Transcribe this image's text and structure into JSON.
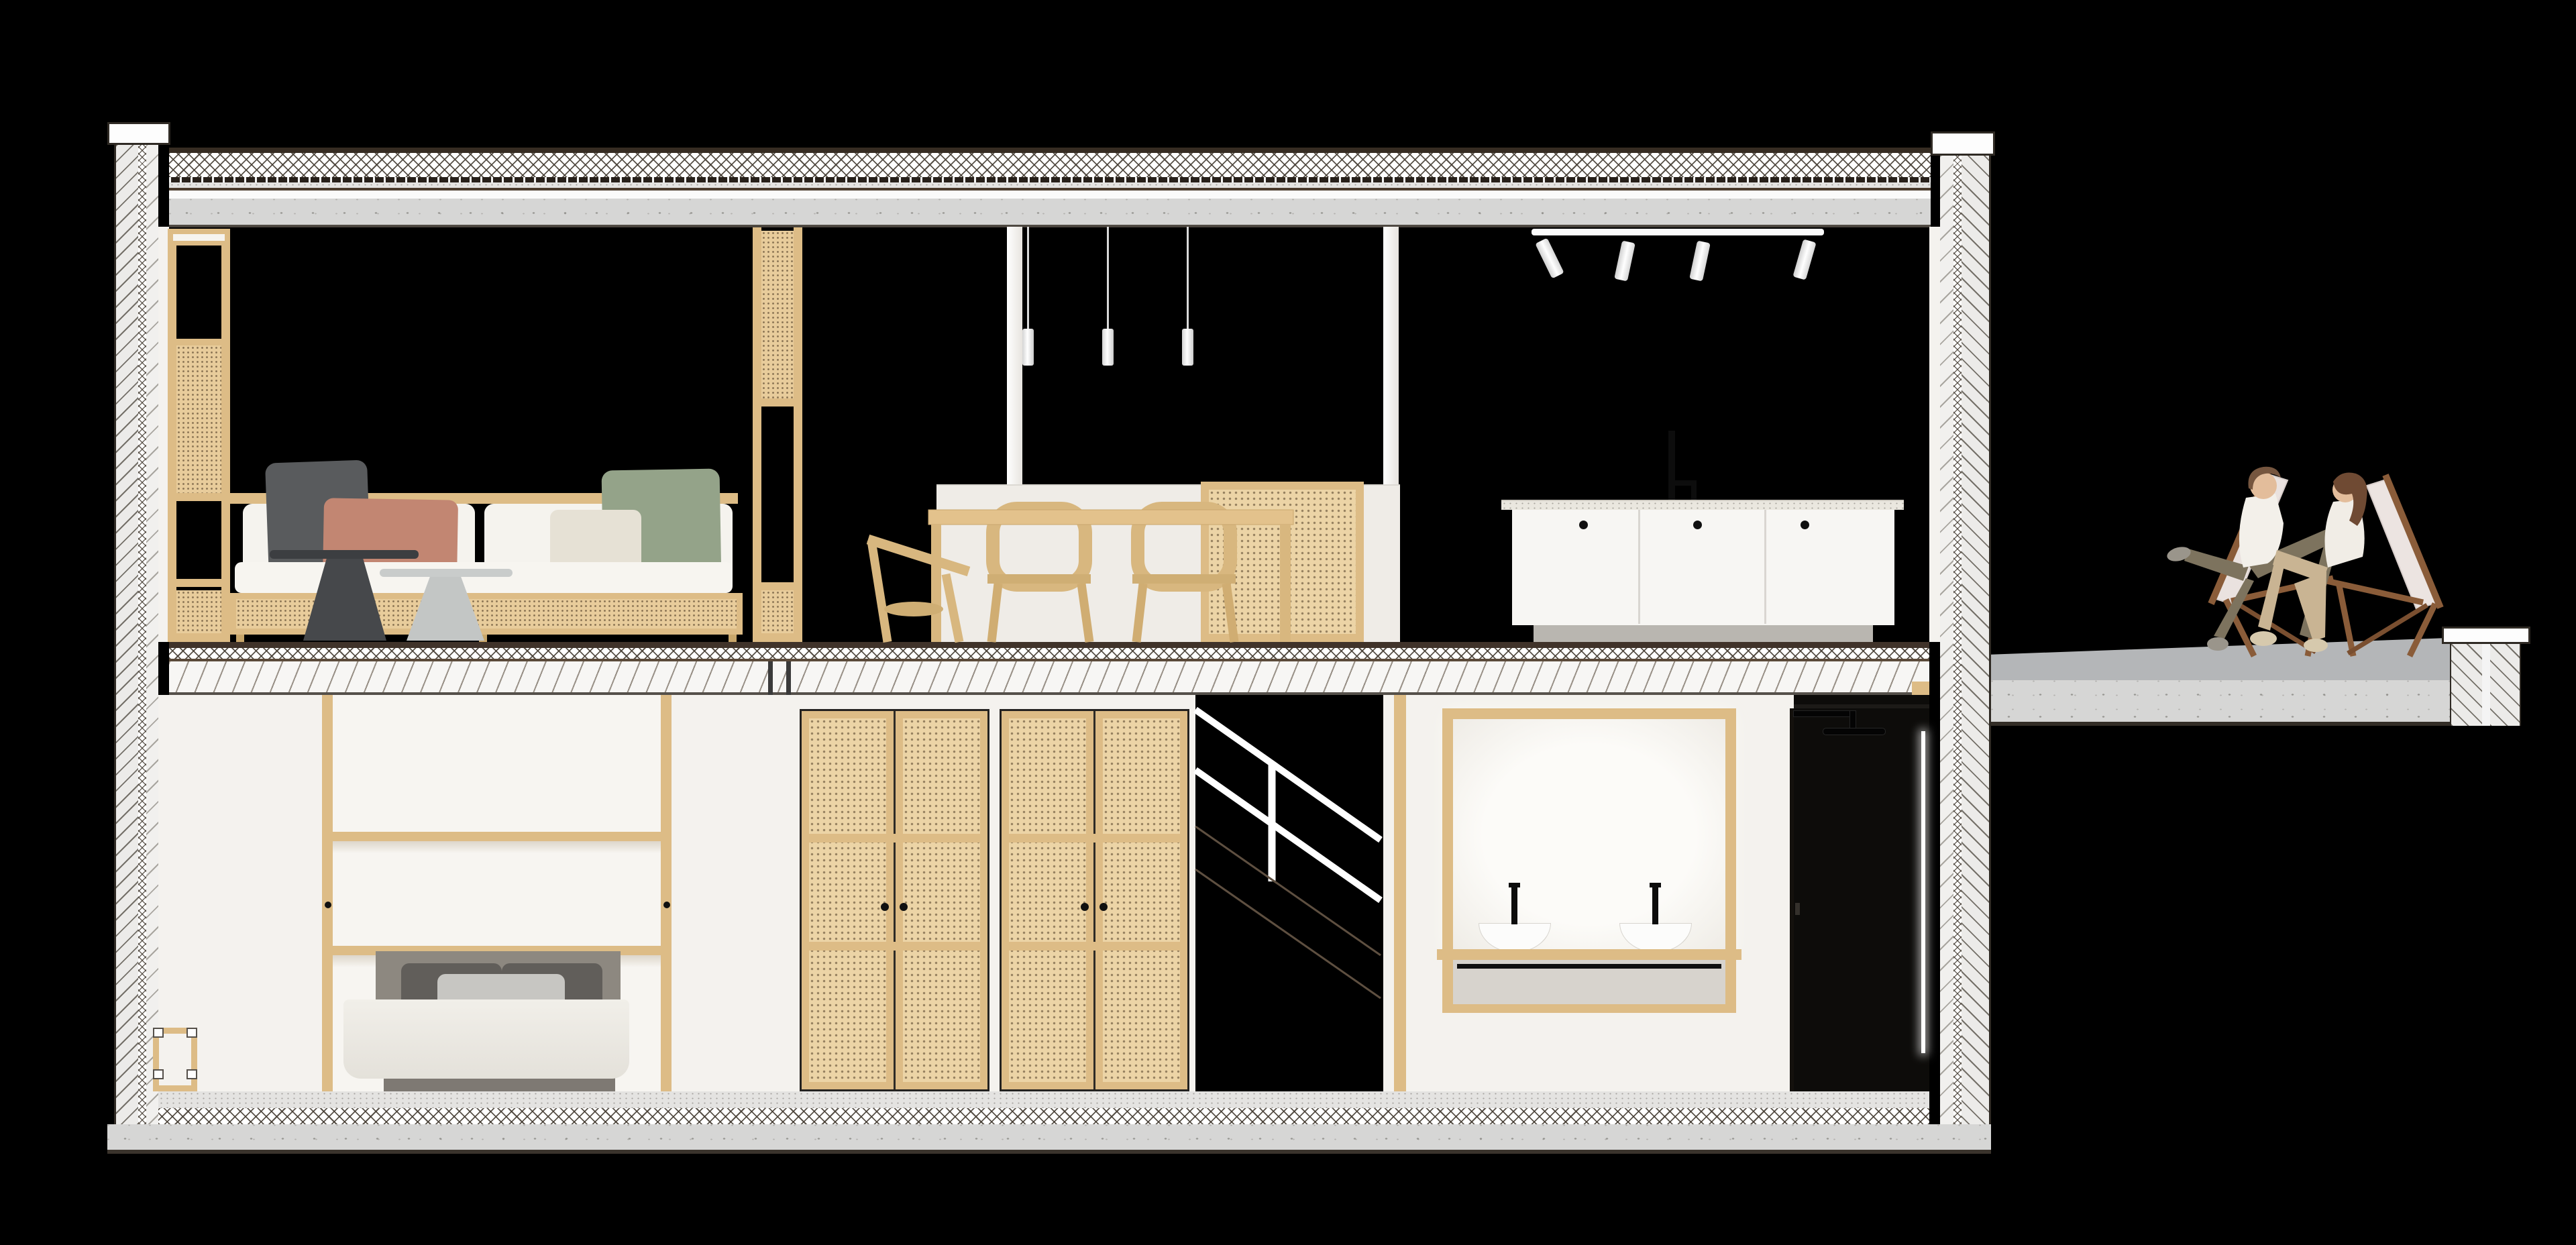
{
  "scene": {
    "type": "architectural cross-section rendering",
    "title": "Two-storey house section with furnished interior and roof terrace",
    "background_color": "#000000",
    "drawing_style": "cut structure shown with hatch patterns, interior elevation rendered in flat colors"
  },
  "palette": {
    "cut_line_dark": "#362c22",
    "concrete_gray": "#d6d6d5",
    "wall_white": "#f4f2ee",
    "wood_light": "#ddbc86",
    "cane_tan": "#e8cc9b",
    "pillow_dark_gray": "#595b5d",
    "pillow_terracotta": "#c28672",
    "pillow_cream": "#e6e1d5",
    "pillow_sage": "#94a389",
    "fixture_black": "#0d0d0d",
    "deckchair_wood_brown": "#8a5c39"
  },
  "structure": {
    "roof_layers": [
      "dark membrane",
      "cross-hatched insulation",
      "dotted separation layer",
      "screed strip",
      "concrete slab with stipple"
    ],
    "mid_floor_layers": [
      "dark finish line",
      "cross-hatched insulation",
      "diagonal wavy screed",
      "steel I-beam under slab"
    ],
    "base_slab_layers": [
      "fine stippled screed",
      "cross-hatched insulation",
      "stippled concrete slab"
    ],
    "walls": [
      "left cavity wall with diagonal hatch and insulation strip",
      "right cavity wall with diagonal hatch",
      "terrace parapet with coping"
    ]
  },
  "upper_floor": {
    "rooms": [
      {
        "name": "living room",
        "furniture": [
          {
            "item": "cane screen post left",
            "material": "wood frame with cane webbing"
          },
          {
            "item": "cane screen post right",
            "material": "wood frame with cane webbing"
          },
          {
            "item": "sofa",
            "details": "wood and cane base, white cushions"
          },
          {
            "item": "pillows",
            "colors": [
              "dark gray",
              "terracotta",
              "cream",
              "sage green"
            ]
          },
          {
            "item": "side table dark",
            "color": "charcoal"
          },
          {
            "item": "side table light",
            "color": "light gray"
          }
        ]
      },
      {
        "name": "dining area",
        "furniture": [
          {
            "item": "pendant lights",
            "count": 3,
            "shape": "white cylinders on thin cords"
          },
          {
            "item": "white columns",
            "count": 2
          },
          {
            "item": "white island block"
          },
          {
            "item": "wooden dining table"
          },
          {
            "item": "wooden chairs",
            "count": 3
          },
          {
            "item": "cane sideboard"
          }
        ]
      },
      {
        "name": "kitchen",
        "furniture": [
          {
            "item": "track light",
            "spots": 4
          },
          {
            "item": "black faucet"
          },
          {
            "item": "stone countertop"
          },
          {
            "item": "white cabinet",
            "doors": 3,
            "knobs": "black"
          }
        ]
      }
    ]
  },
  "lower_floor": {
    "rooms": [
      {
        "name": "bedroom",
        "furniture": [
          {
            "item": "wall bed unit",
            "details": "wood posts, two shelves, black knobs"
          },
          {
            "item": "bed",
            "details": "gray headboard, two dark pillows, one light pillow, white duvet"
          },
          {
            "item": "wooden stool"
          }
        ]
      },
      {
        "name": "wardrobe hall",
        "furniture": [
          {
            "item": "cane wardrobe unit",
            "count": 2,
            "details": "double doors, black knobs, three panels each"
          }
        ]
      },
      {
        "name": "staircase",
        "details": "dark void with white handrail lines and faint stringer lines"
      },
      {
        "name": "bathroom",
        "furniture": [
          {
            "item": "backlit wood framed mirror"
          },
          {
            "item": "double vessel sinks",
            "count": 2,
            "faucets": "black"
          },
          {
            "item": "wood vanity shelf with black towel bar"
          }
        ]
      },
      {
        "name": "shower room",
        "details": "dark room with black rain shower head and vertical LED strip, dark door with handle"
      }
    ]
  },
  "exterior": {
    "terrace": {
      "details": "concrete deck with slight slope, parapet wall with white coping",
      "furniture": [
        {
          "item": "wooden deck chairs",
          "count": 2,
          "canvas": "off-white"
        }
      ],
      "people": [
        {
          "who": "man",
          "clothes": "white t-shirt, olive trousers, gray shoes",
          "pose": "reclining, legs crossed"
        },
        {
          "who": "woman",
          "clothes": "white top, tan trousers, beige shoes",
          "pose": "reclining, facing the man"
        }
      ]
    }
  }
}
